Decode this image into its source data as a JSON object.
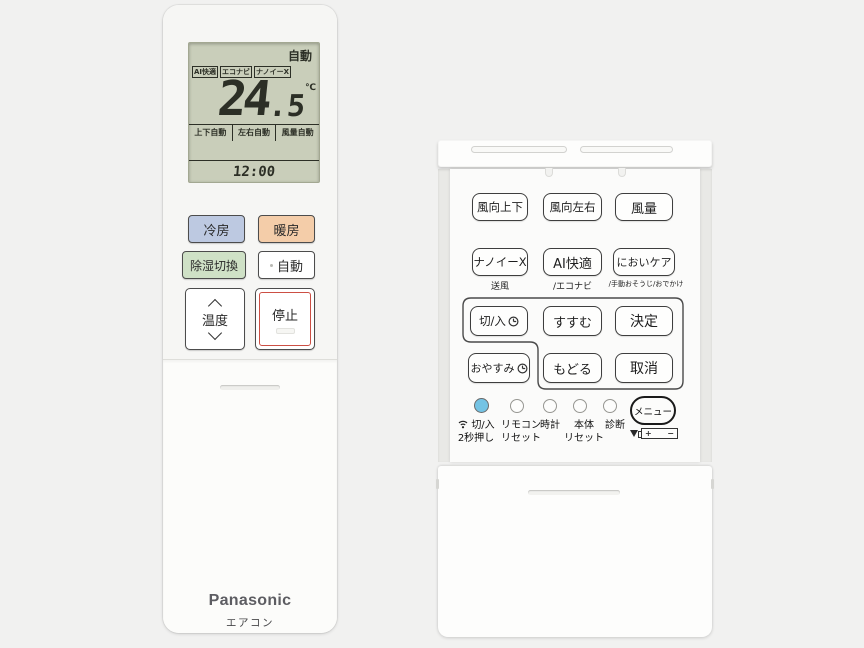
{
  "left_remote": {
    "lcd": {
      "mode": "自動",
      "badges": [
        "AI快適",
        "エコナビ",
        "ナノイーX"
      ],
      "temperature_int": "24",
      "temperature_dec": ".5",
      "temperature_unit": "℃",
      "status_items": [
        "上下自動",
        "左右自動",
        "風量自動"
      ],
      "time": "12:00",
      "bg_color": "#c9ceba"
    },
    "buttons": {
      "cool": {
        "label": "冷房",
        "color": "#bdc9e1"
      },
      "heat": {
        "label": "暖房",
        "color": "#f4cda9"
      },
      "dehumidify": {
        "label": "除湿切換",
        "color": "#cfe1c6"
      },
      "auto": {
        "label": "自動"
      },
      "temperature": {
        "label": "温度"
      },
      "stop": {
        "label": "停止",
        "accent_color": "#cc4f44"
      }
    },
    "brand": "Panasonic",
    "product_type": "エアコン"
  },
  "right_remote": {
    "row1": [
      "風向上下",
      "風向左右",
      "風量"
    ],
    "row2": [
      "ナノイーX",
      "AI快適",
      "においケア"
    ],
    "row2_sub": [
      "送風",
      "/エコナビ",
      "/手動おそうじ/おでかけ"
    ],
    "timer_group": {
      "on_off": "切/入",
      "forward": "すすむ",
      "enter": "決定",
      "sleep": "おやすみ",
      "back": "もどる",
      "cancel": "取消"
    },
    "bottom": {
      "wireless_power": {
        "label": "切/入",
        "sub": "2秒押し"
      },
      "remote_reset": {
        "label": "リモコン",
        "sub": "リセット"
      },
      "clock": {
        "label": "時計"
      },
      "unit_reset": {
        "label": "本体",
        "sub": "リセット"
      },
      "diagnosis": {
        "label": "診断"
      },
      "menu": "メニュー",
      "battery": {
        "plus": "+",
        "minus": "−"
      },
      "power_dot_color": "#74c3e4"
    }
  }
}
